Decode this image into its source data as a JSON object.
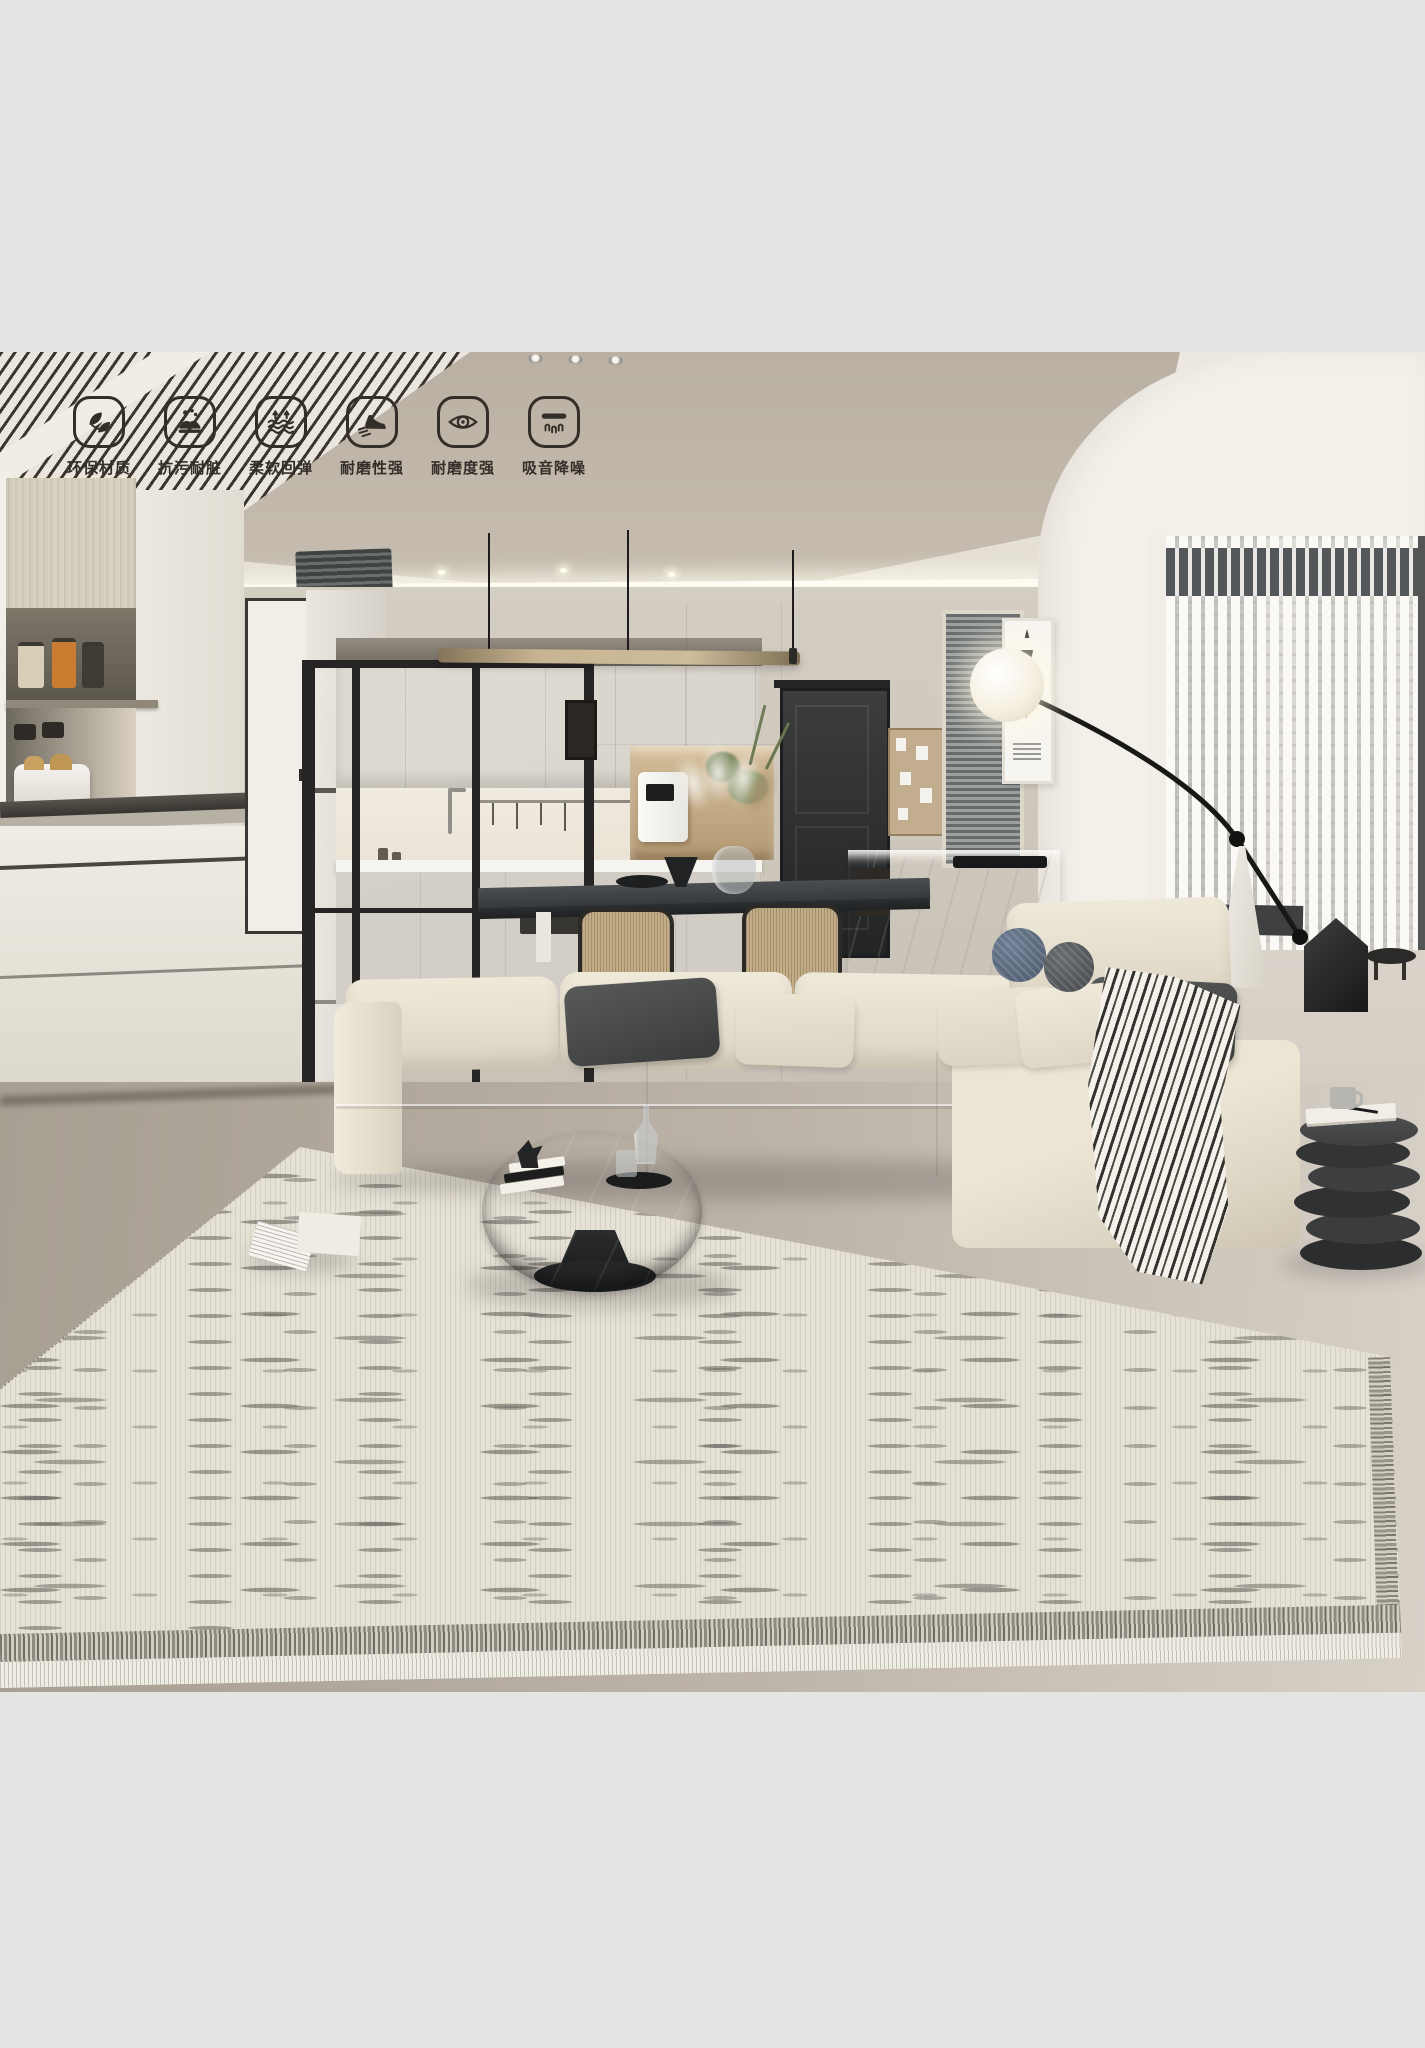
{
  "page": {
    "background": "#e4e5e3"
  },
  "photo": {
    "description": "Modern beige living room with open kitchen, cream sectional sofa, arc floor lamp, black round coffee table and striped cream area rug",
    "palette": {
      "ceiling": "#bfb6a9",
      "wall": "#cdc6bb",
      "floor_left": "#a9a095",
      "floor_right": "#d6d0c7",
      "sofa_cream": "#e7e0d0",
      "pillow_dark": "#454746",
      "coffee_table": "#3a3c3e",
      "rug_base": "#e6e1d5",
      "rug_speckle": "#6d6b65",
      "icon_color": "#332e28"
    }
  },
  "features": {
    "items": [
      {
        "icon": "leaf-icon",
        "label": "环保材质"
      },
      {
        "icon": "stain-resistant-icon",
        "label": "抗污耐脏"
      },
      {
        "icon": "soft-rebound-icon",
        "label": "柔软回弹"
      },
      {
        "icon": "wear-resistant-shoe-icon",
        "label": "耐磨性强"
      },
      {
        "icon": "durable-eye-icon",
        "label": "耐磨度强"
      },
      {
        "icon": "sound-absorb-icon",
        "label": "吸音降噪"
      }
    ]
  }
}
